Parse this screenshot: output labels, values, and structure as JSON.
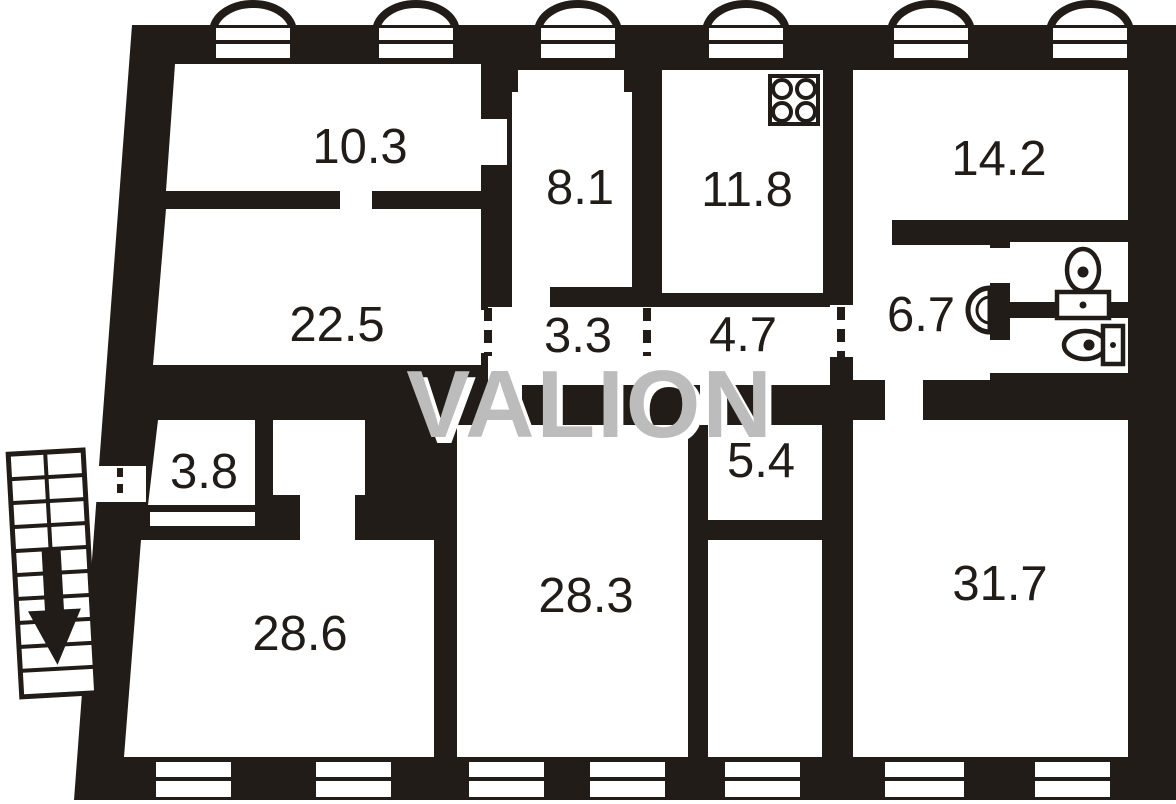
{
  "title": "apartment-floor-plan",
  "watermark": {
    "text": "VALION",
    "color": "#bcbcbc",
    "shadow_color": "#ffffff"
  },
  "colors": {
    "walls": "#211c18",
    "background": "#ffffff",
    "labels": "#211c18"
  },
  "rooms": [
    {
      "name": "room-10-3",
      "area_label": "10.3"
    },
    {
      "name": "room-22-5",
      "area_label": "22.5"
    },
    {
      "name": "room-8-1",
      "area_label": "8.1"
    },
    {
      "name": "room-11-8-kitchen",
      "area_label": "11.8"
    },
    {
      "name": "room-14-2",
      "area_label": "14.2"
    },
    {
      "name": "hall-6-7",
      "area_label": "6.7"
    },
    {
      "name": "corridor-3-3",
      "area_label": "3.3"
    },
    {
      "name": "corridor-4-7",
      "area_label": "4.7"
    },
    {
      "name": "room-5-4",
      "area_label": "5.4"
    },
    {
      "name": "hall-3-8",
      "area_label": "3.8"
    },
    {
      "name": "room-28-6",
      "area_label": "28.6"
    },
    {
      "name": "room-28-3",
      "area_label": "28.3"
    },
    {
      "name": "room-31-7",
      "area_label": "31.7"
    }
  ],
  "icons": [
    {
      "name": "stove-icon"
    },
    {
      "name": "washbasin-icon"
    },
    {
      "name": "toilet-icon"
    },
    {
      "name": "sink-icon"
    },
    {
      "name": "stairs-icon"
    },
    {
      "name": "down-arrow-icon"
    }
  ],
  "features": {
    "balcony_arches": 6,
    "top_windows": 6,
    "bottom_windows": 7,
    "door_openings": 4
  }
}
